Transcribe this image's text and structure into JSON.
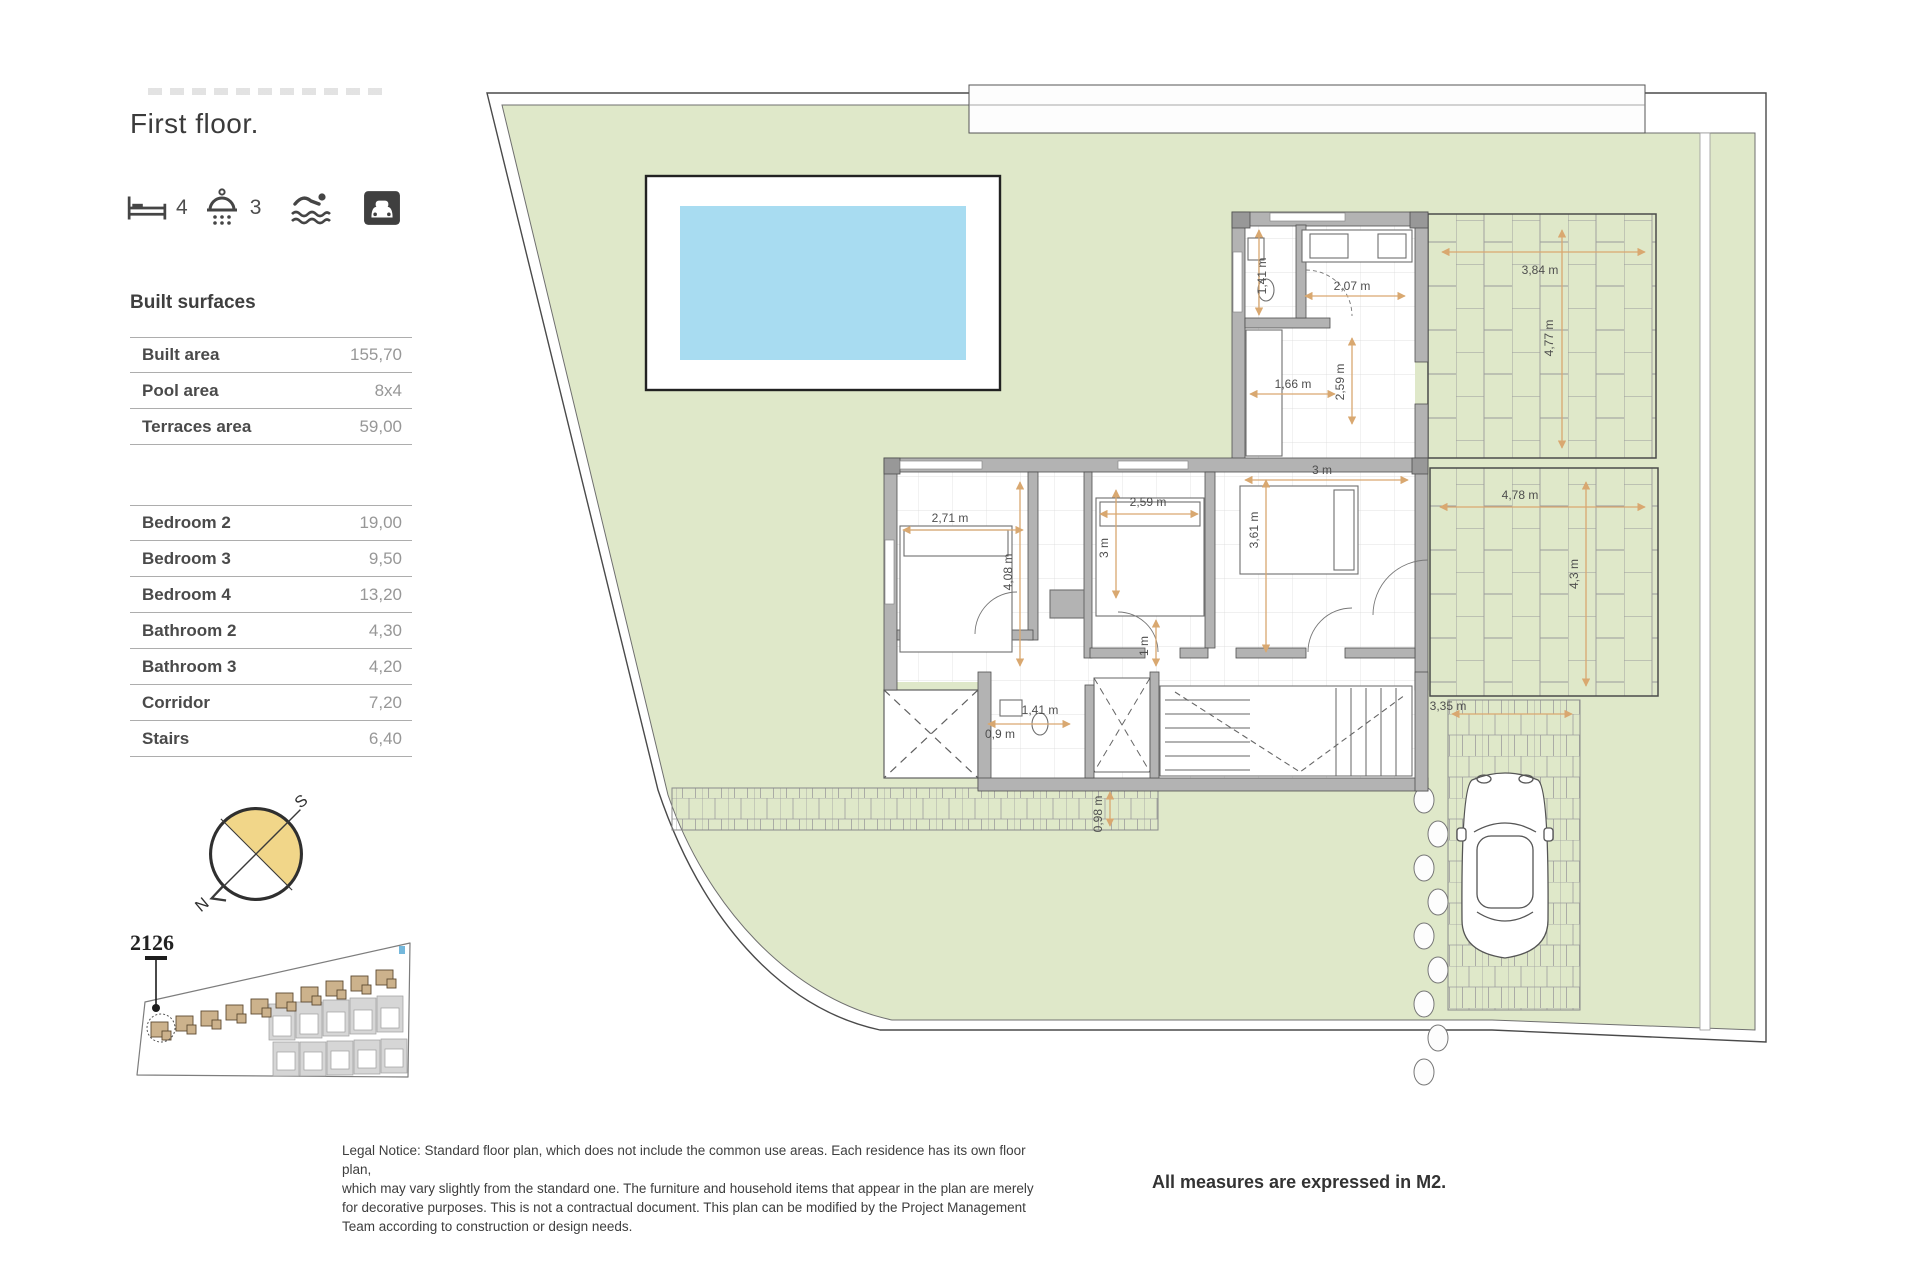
{
  "page": {
    "title": "First floor."
  },
  "amenities": {
    "bedrooms": "4",
    "bathrooms": "3"
  },
  "built_surfaces": {
    "heading": "Built surfaces",
    "rows": [
      {
        "label": "Built area",
        "value": "155,70"
      },
      {
        "label": "Pool area",
        "value": "8x4"
      },
      {
        "label": "Terraces area",
        "value": "59,00"
      }
    ]
  },
  "rooms": {
    "rows": [
      {
        "label": "Bedroom 2",
        "value": "19,00"
      },
      {
        "label": "Bedroom 3",
        "value": "9,50"
      },
      {
        "label": "Bedroom 4",
        "value": "13,20"
      },
      {
        "label": "Bathroom 2",
        "value": "4,30"
      },
      {
        "label": "Bathroom 3",
        "value": "4,20"
      },
      {
        "label": "Corridor",
        "value": "7,20"
      },
      {
        "label": "Stairs",
        "value": "6,40"
      }
    ]
  },
  "compass": {
    "north": "N",
    "south": "S"
  },
  "site_plan": {
    "plot_number": "2126"
  },
  "plan": {
    "dimensions": [
      {
        "text": "1,41 m"
      },
      {
        "text": "2,07 m"
      },
      {
        "text": "3,84 m"
      },
      {
        "text": "4,77 m"
      },
      {
        "text": "1,66 m"
      },
      {
        "text": "2,59 m"
      },
      {
        "text": "3 m"
      },
      {
        "text": "2,71 m"
      },
      {
        "text": "2,59 m"
      },
      {
        "text": "3 m"
      },
      {
        "text": "3,61 m"
      },
      {
        "text": "4,08 m"
      },
      {
        "text": "4,78 m"
      },
      {
        "text": "4,3 m"
      },
      {
        "text": "1 m"
      },
      {
        "text": "1,41 m"
      },
      {
        "text": "0,9 m"
      },
      {
        "text": "0,98 m"
      },
      {
        "text": "3,35 m"
      }
    ]
  },
  "footer": {
    "legal_lines": [
      "Legal Notice: Standard floor plan, which does not include the common use areas. Each residence has its own floor plan,",
      "which may vary slightly from the standard one. The furniture and household items that appear in the plan are merely",
      "for decorative purposes. This is not a contractual document. This plan can be modified by the Project Management",
      "Team according to construction or design needs."
    ],
    "measures_note": "All measures are expressed in M2."
  },
  "colors": {
    "garden": "#dfe8c9",
    "pool_water": "#a8dcf1",
    "wall": "#b3b3b3",
    "compass_fill": "#f1d689",
    "dimension_arrow": "#d9a870"
  }
}
